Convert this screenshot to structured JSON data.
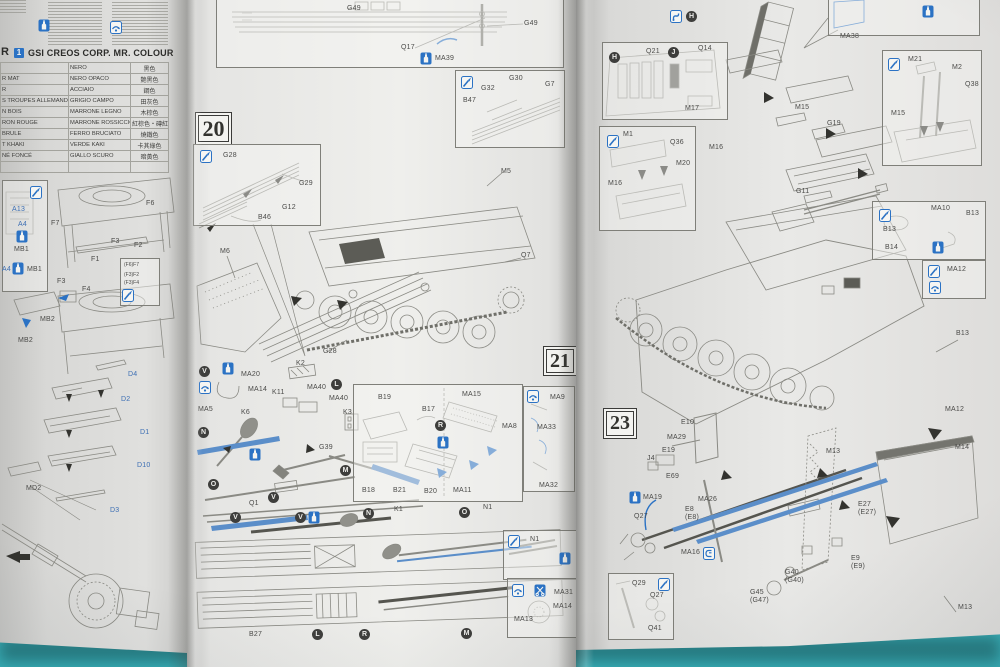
{
  "photo": {
    "surface_color": "#4cc2c9",
    "paper_color": "#e5e5e3",
    "accent_blue": "#2b72c4",
    "line_gray": "#85857f"
  },
  "letters": {
    "v": "V",
    "n": "N",
    "o": "O",
    "l": "L",
    "m": "M",
    "r": "R",
    "h": "H",
    "j": "J"
  },
  "icons": {
    "paint": "paint-brush-icon",
    "glue": "glue-bottle-icon",
    "opt": "option-arrow-icon",
    "cut": "modify-icon",
    "clip": "clip-icon",
    "tool": "tool-icon"
  },
  "left_page": {
    "header": {
      "prefix": "R",
      "badge": "1",
      "title": "GSI CREOS CORP. MR. COLOUR"
    },
    "color_chart": {
      "rows": [
        {
          "fr": "",
          "it": "NERO",
          "zh": "黑色"
        },
        {
          "fr": "R MAT",
          "it": "NERO OPACO",
          "zh": "艶黑色"
        },
        {
          "fr": "R",
          "it": "ACCIAIO",
          "zh": "鋼色"
        },
        {
          "fr": "S TROUPES ALLEMANDES(1)",
          "it": "GRIGIO CAMPO",
          "zh": "田灰色"
        },
        {
          "fr": "N BOIS",
          "it": "MARRONE LEGNO",
          "zh": "木棕色"
        },
        {
          "fr": "RON ROUGE",
          "it": "MARRONE ROSSICCIO",
          "zh": "紅棕色・磚紅色"
        },
        {
          "fr": "BRULE",
          "it": "FERRO BRUCIATO",
          "zh": "燒鐵色"
        },
        {
          "fr": "T KHAKI",
          "it": "VERDE KAKI",
          "zh": "卡其綠色"
        },
        {
          "fr": "NÉ FONCÉ",
          "it": "GIALLO SCURO",
          "zh": "暗黃色"
        },
        {
          "fr": "",
          "it": "",
          "zh": ""
        }
      ]
    },
    "labels": {
      "a13": "A13",
      "a4_a": "A4",
      "mb1_a": "MB1",
      "a4_b": "A4",
      "mb1_b": "MB1",
      "mb2_a": "MB2",
      "mb2_b": "MB2",
      "f7": "F7",
      "f6": "F6",
      "f1": "F1",
      "f2": "F2",
      "f3_a": "F3",
      "f3_b": "F3",
      "f4": "F4",
      "d4": "D4",
      "d2": "D2",
      "d1": "D1",
      "d10": "D10",
      "d3": "D3",
      "md2": "MD2"
    },
    "jig_note": {
      "l1": "(F6)F7",
      "l2": "(F3)F2",
      "l3": "(F3)F4"
    }
  },
  "middle_page": {
    "steps": {
      "s20": "20",
      "s21": "21"
    },
    "labels": {
      "g49_a": "G49",
      "g49_b": "G49",
      "q17": "Q17",
      "ma39": "MA39",
      "g28_a": "G28",
      "g29": "G29",
      "g12": "G12",
      "b46": "B46",
      "m6": "M6",
      "m5": "M5",
      "q7": "Q7",
      "g28_b": "G28",
      "b47": "B47",
      "g32": "G32",
      "g30": "G30",
      "g7": "G7",
      "ma20": "MA20",
      "ma14": "MA14",
      "ma5": "MA5",
      "k6": "K6",
      "k2": "K2",
      "k11": "K11",
      "ma40_a": "MA40",
      "ma40_b": "MA40",
      "k3": "K3",
      "g39": "G39",
      "q1": "Q1",
      "b19": "B19",
      "b17": "B17",
      "b18": "B18",
      "b21": "B21",
      "b20": "B20",
      "ma15": "MA15",
      "ma8": "MA8",
      "ma11": "MA11",
      "ma9": "MA9",
      "ma33": "MA33",
      "ma32": "MA32",
      "k1": "K1",
      "n1_a": "N1",
      "n1_b": "N1",
      "b27": "B27",
      "ma31": "MA31",
      "ma14_b": "MA14",
      "ma13": "MA13"
    }
  },
  "right_page": {
    "steps": {
      "s23": "23"
    },
    "labels": {
      "q21": "Q21",
      "q14": "Q14",
      "m17": "M17",
      "ma38": "MA38",
      "m21": "M21",
      "m2": "M2",
      "q38": "Q38",
      "m15_a": "M15",
      "m15_b": "M15",
      "g19": "G19",
      "m1": "M1",
      "q36": "Q36",
      "m20": "M20",
      "m16_a": "M16",
      "m16_b": "M16",
      "g11": "G11",
      "ma10": "MA10",
      "b13_a": "B13",
      "b13_b": "B13",
      "b14": "B14",
      "b13_c": "B13",
      "ma12_a": "MA12",
      "ma12_b": "MA12",
      "e10": "E10",
      "ma29": "MA29",
      "e19": "E19",
      "j4": "J4",
      "e69": "E69",
      "ma19": "MA19",
      "ma26": "MA26",
      "e8": "E8\n(E8)",
      "q27_a": "Q27",
      "ma16": "MA16",
      "m13_a": "M13",
      "m14": "M14",
      "e27": "E27\n(E27)",
      "e9": "E9\n(E9)",
      "m13_b": "M13",
      "g40": "G40\n(G40)",
      "g45": "G45\n(G47)",
      "q29": "Q29",
      "q27_b": "Q27",
      "q41": "Q41"
    }
  }
}
